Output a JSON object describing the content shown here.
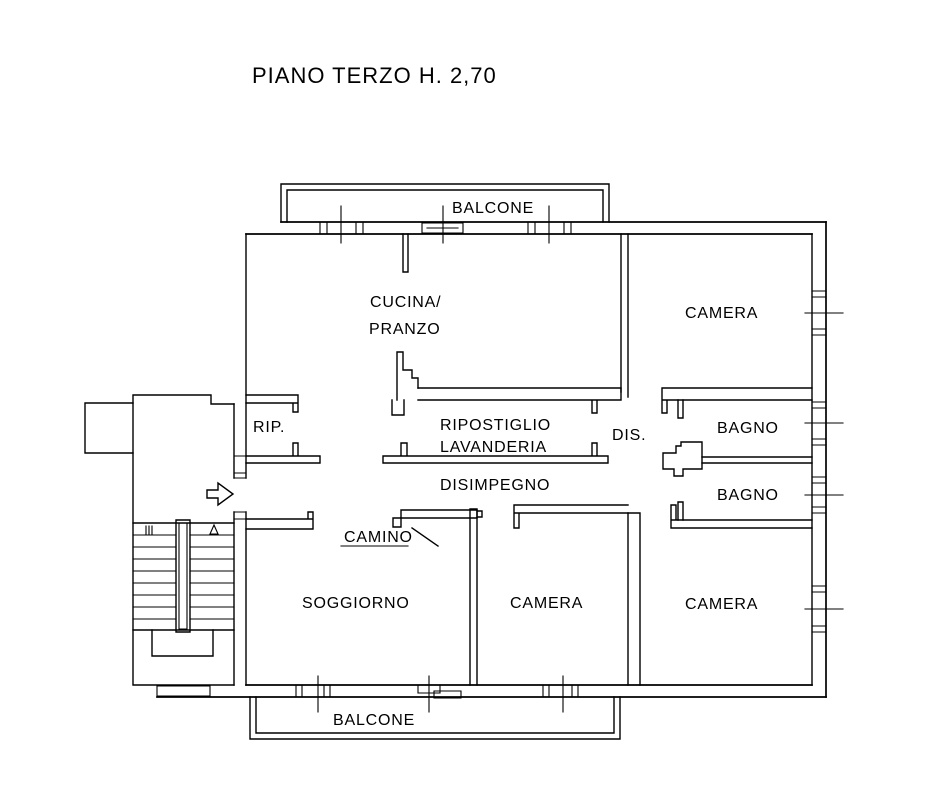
{
  "title": "PIANO TERZO H. 2,70",
  "colors": {
    "line": "#000000",
    "background": "#ffffff"
  },
  "floor_plan": {
    "rooms": {
      "balcone_top": "BALCONE",
      "cucina_line1": "CUCINA/",
      "cucina_line2": "PRANZO",
      "camera_ne": "CAMERA",
      "rip": "RIP.",
      "ripostiglio_line1": "RIPOSTIGLIO",
      "ripostiglio_line2": "LAVANDERIA",
      "dis": "DIS.",
      "bagno_1": "BAGNO",
      "bagno_2": "BAGNO",
      "disimpegno": "DISIMPEGNO",
      "camino": "CAMINO",
      "soggiorno": "SOGGIORNO",
      "camera_s": "CAMERA",
      "camera_se": "CAMERA",
      "balcone_bottom": "BALCONE"
    }
  }
}
